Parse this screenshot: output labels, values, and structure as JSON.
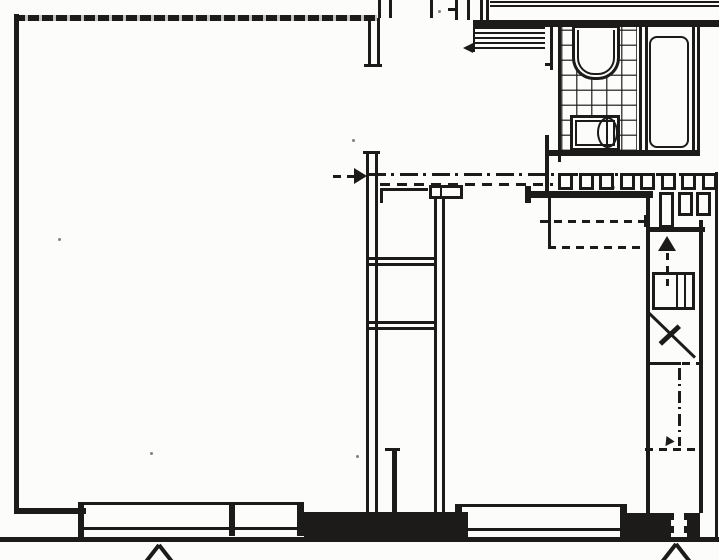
{
  "document": {
    "kind": "scanned architectural floor plan, black ink line drawing, no text labels"
  },
  "colors": {
    "paper": "#fcfcfa",
    "ink": "#1c1b19"
  },
  "symbols": {
    "section_arrow": {
      "direction": "right",
      "style": "dashed shaft, solid head"
    },
    "duct_arrow": {
      "direction": "left"
    },
    "stair_direction_arrow": {
      "direction": "up",
      "style": "solid head, dashed tail"
    },
    "flow_arrow_vertical": {
      "direction": "down",
      "style": "dash-dot line with small head"
    },
    "entrance_arrow_left_window": {
      "direction": "up"
    },
    "entrance_arrow_right_door": {
      "direction": "up"
    }
  },
  "fixtures": [
    {
      "name": "toilet",
      "room": "bathroom"
    },
    {
      "name": "washbasin",
      "room": "bathroom"
    },
    {
      "name": "bathtub",
      "room": "bath-niche"
    }
  ],
  "repeat": {
    "railing_posts": {
      "count": 8,
      "x": 558,
      "y": 173,
      "w": 15,
      "h": 17,
      "step": 20.5
    },
    "lower_posts": {
      "count": 3,
      "x": 659,
      "y": 192,
      "w": 15,
      "step": 18.5,
      "heights": [
        36,
        24,
        24
      ]
    },
    "bath_tile_cell_px": 15,
    "duct_hatch_period_px": 5
  }
}
